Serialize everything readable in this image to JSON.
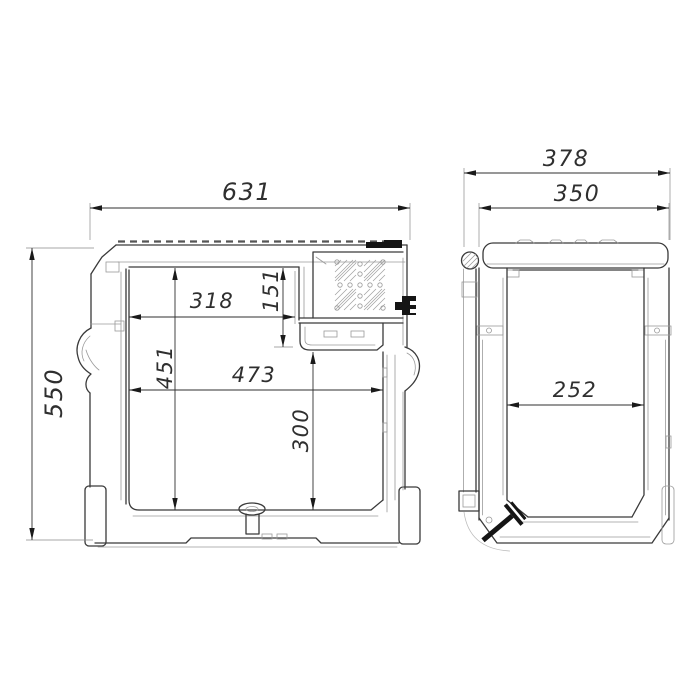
{
  "style": {
    "background": "#ffffff",
    "line_color": "#3a3a3a",
    "thin_line_color": "#9a9a9a",
    "dimension_text_color": "#2f2f2f"
  },
  "front_view": {
    "overall_width": "631",
    "overall_height": "550",
    "inner_width_top": "318",
    "recess_height": "151",
    "inner_height_total": "451",
    "inner_width_bottom": "473",
    "inner_height_under_recess": "300"
  },
  "side_view": {
    "overall_depth": "378",
    "body_depth": "350",
    "inner_width": "252"
  }
}
